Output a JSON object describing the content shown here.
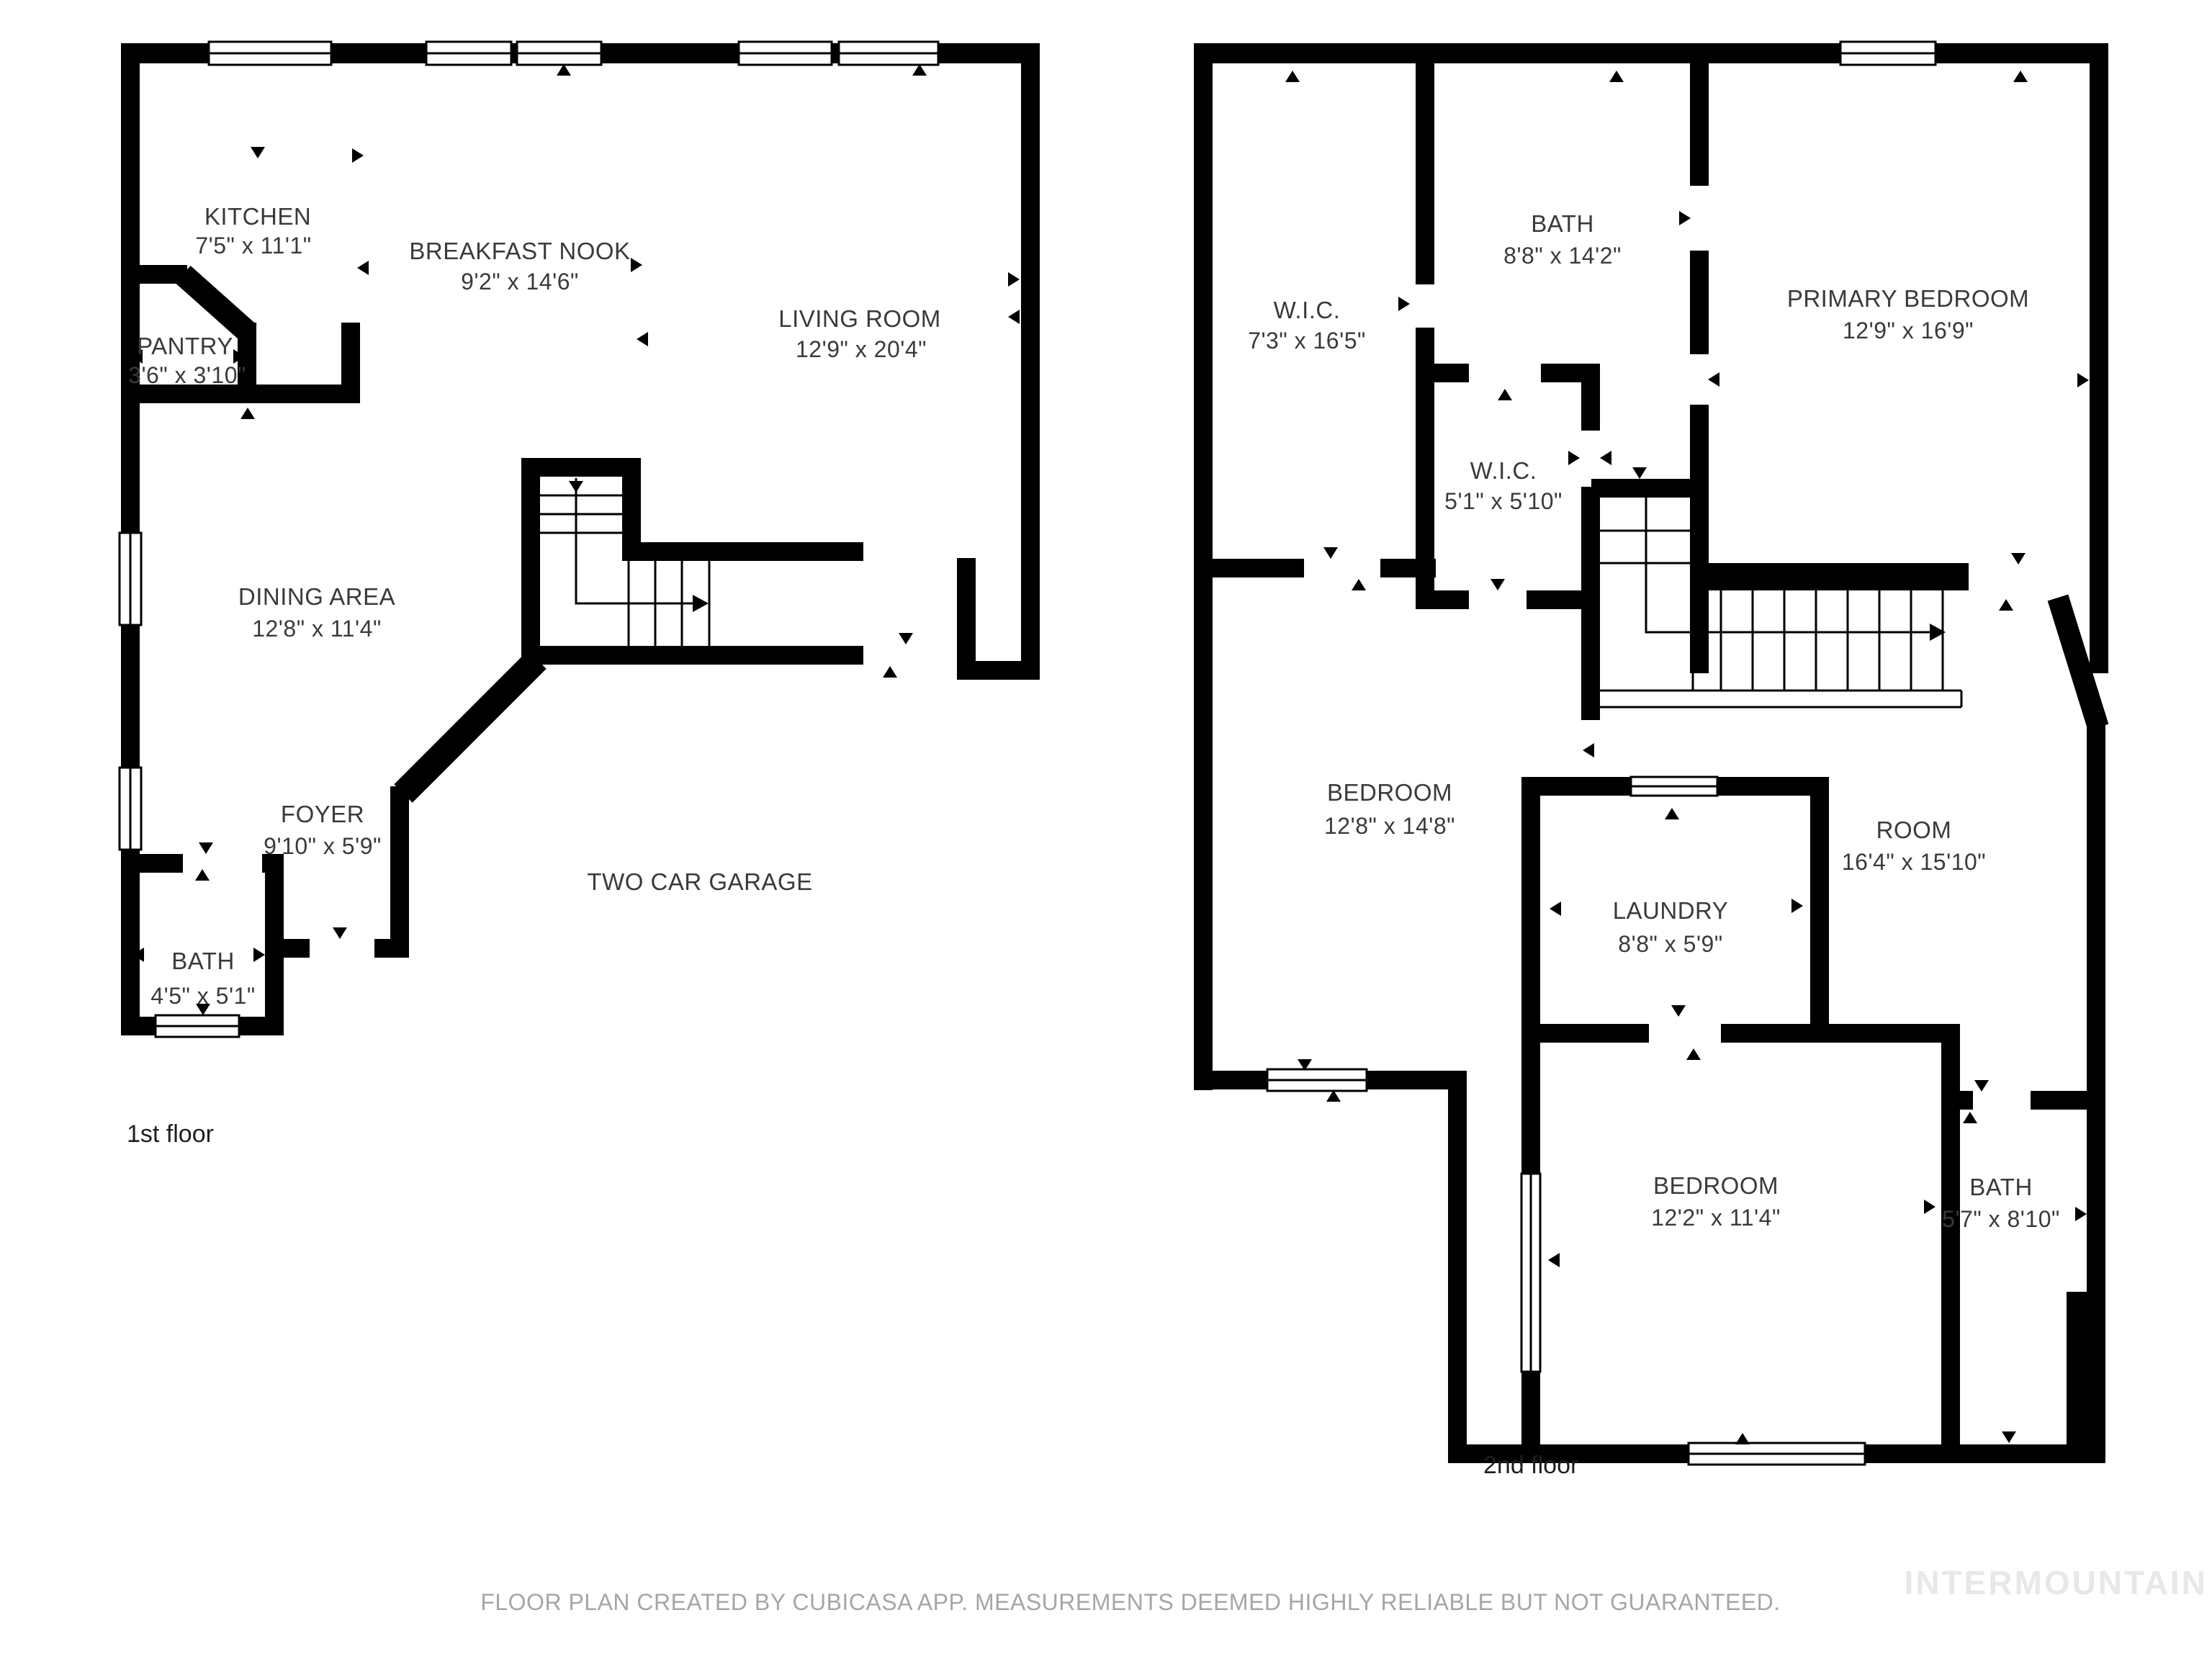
{
  "document": {
    "type": "floor-plan",
    "colors": {
      "wall": "#000000",
      "label_text": "#3a3a3a",
      "disclaimer_text": "#a6a6a6",
      "watermark_text": "#e8e8e8",
      "background": "#ffffff"
    }
  },
  "floors": [
    {
      "label": "1st floor",
      "rooms": [
        {
          "name": "KITCHEN",
          "dims": "7'5\" x 11'1\""
        },
        {
          "name": "BREAKFAST NOOK",
          "dims": "9'2\" x 14'6\""
        },
        {
          "name": "PANTRY",
          "dims": "3'6\" x 3'10\""
        },
        {
          "name": "LIVING ROOM",
          "dims": "12'9\" x 20'4\""
        },
        {
          "name": "DINING AREA",
          "dims": "12'8\" x 11'4\""
        },
        {
          "name": "FOYER",
          "dims": "9'10\" x 5'9\""
        },
        {
          "name": "BATH",
          "dims": "4'5\" x 5'1\""
        },
        {
          "name": "TWO CAR GARAGE"
        }
      ]
    },
    {
      "label": "2nd floor",
      "rooms": [
        {
          "name": "W.I.C.",
          "dims": "7'3\" x 16'5\""
        },
        {
          "name": "BATH",
          "dims": "8'8\" x 14'2\""
        },
        {
          "name": "PRIMARY BEDROOM",
          "dims": "12'9\" x 16'9\""
        },
        {
          "name": "W.I.C.",
          "dims": "5'1\" x 5'10\""
        },
        {
          "name": "BEDROOM",
          "dims": "12'8\" x 14'8\""
        },
        {
          "name": "ROOM",
          "dims": "16'4\" x 15'10\""
        },
        {
          "name": "LAUNDRY",
          "dims": "8'8\" x 5'9\""
        },
        {
          "name": "BEDROOM",
          "dims": "12'2\" x 11'4\""
        },
        {
          "name": "BATH",
          "dims": "5'7\" x 8'10\""
        }
      ]
    }
  ],
  "footer": {
    "disclaimer": "FLOOR PLAN CREATED BY CUBICASA APP. MEASUREMENTS DEEMED HIGHLY RELIABLE BUT NOT GUARANTEED.",
    "watermark": "INTERMOUNTAIN"
  }
}
